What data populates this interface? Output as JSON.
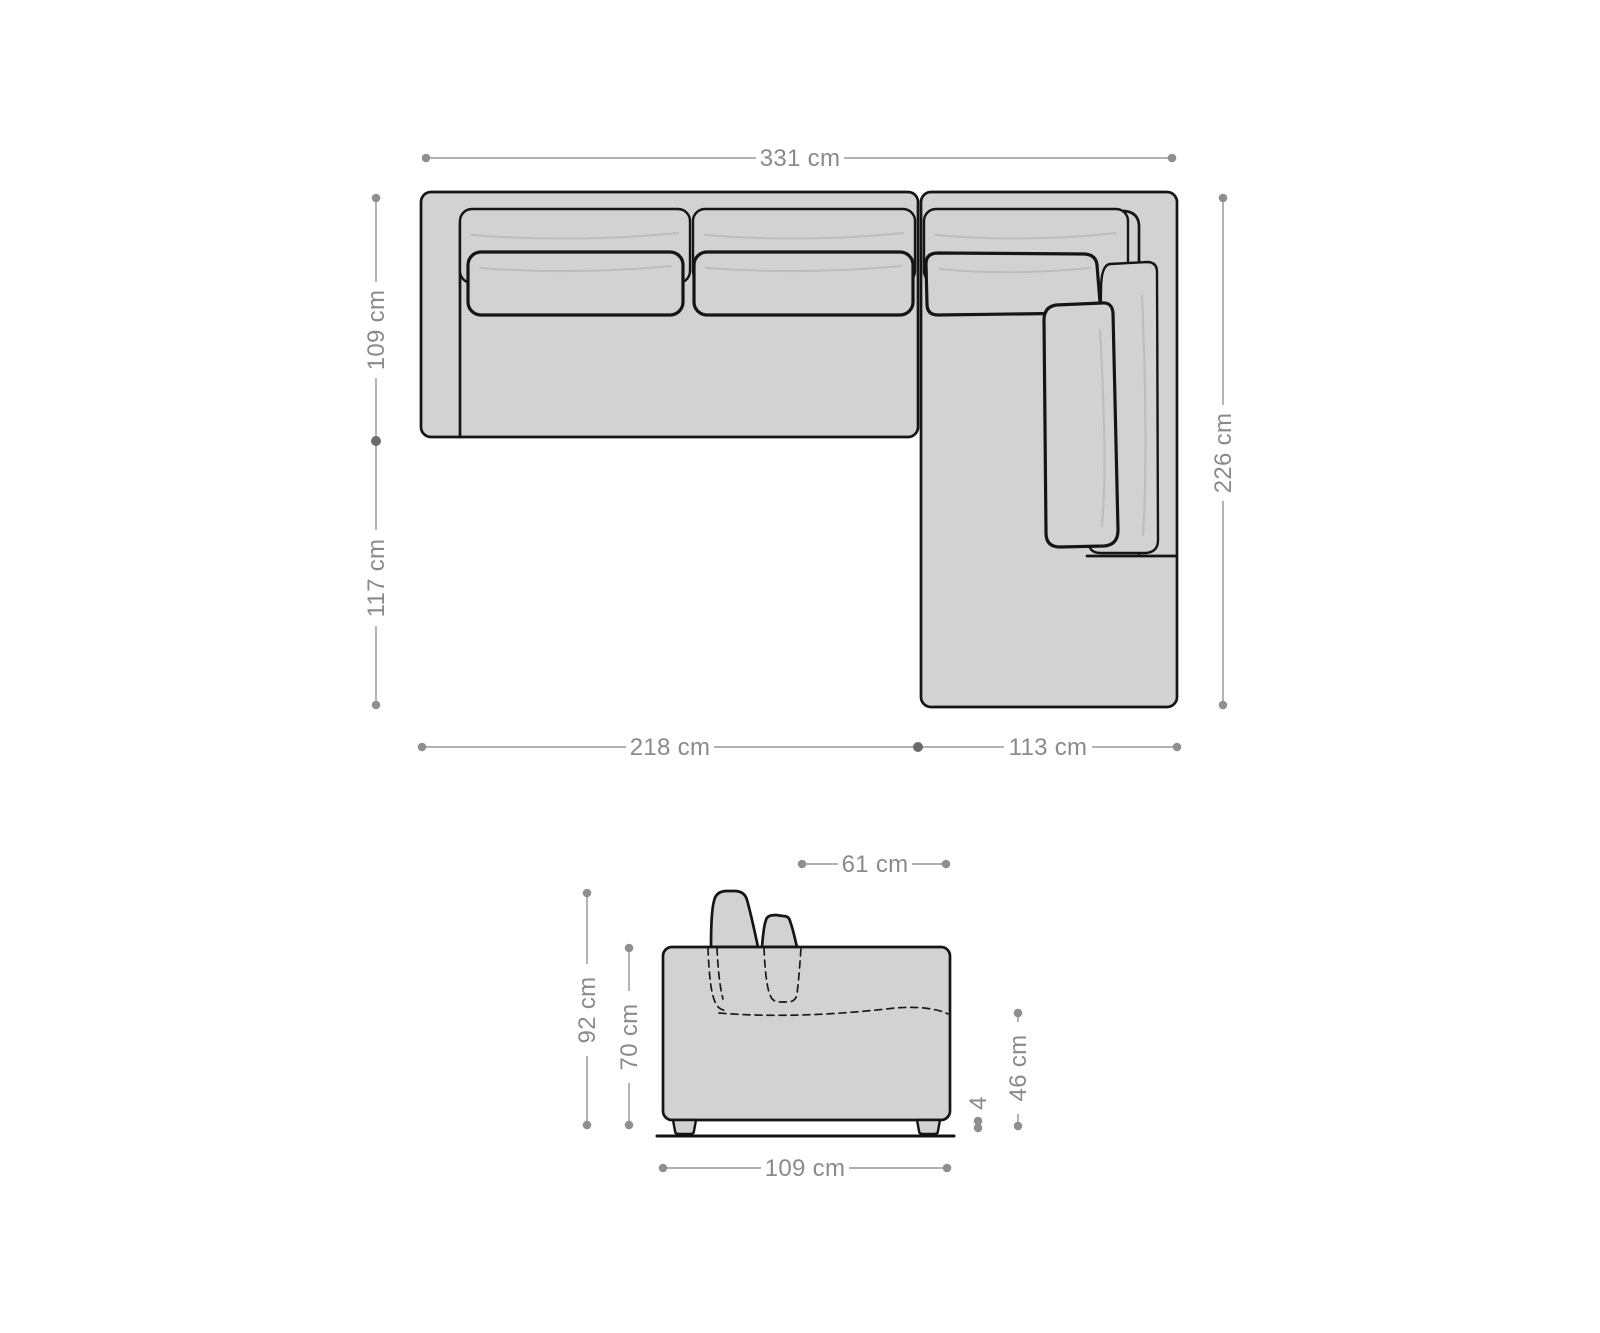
{
  "diagram": {
    "type": "corner-sofa-dimension-diagram",
    "views": {
      "top_view": "sofa seen from above with recamiere on the right",
      "side_view": "sofa seen from the side with backrest cushions and feet"
    }
  },
  "colors": {
    "background": "#ffffff",
    "sofa_fill": "#d2d2d2",
    "outline": "#151515",
    "seam_line": "#bcbcbc",
    "dimension_line": "#a6a6a6",
    "dimension_text": "#8a8a8a",
    "dashed_line": "#1a1a1a"
  },
  "measurements": {
    "top_view": {
      "total_width": "331 cm",
      "sofa_depth": "109 cm",
      "recamiere_extra_depth": "117 cm",
      "total_depth": "226 cm",
      "sofa_width": "218 cm",
      "recamiere_width": "113 cm"
    },
    "side_view": {
      "seat_depth": "61 cm",
      "total_height": "92 cm",
      "body_height": "70 cm",
      "seat_height": "46 cm",
      "foot_height": "4",
      "total_depth": "109 cm"
    }
  }
}
